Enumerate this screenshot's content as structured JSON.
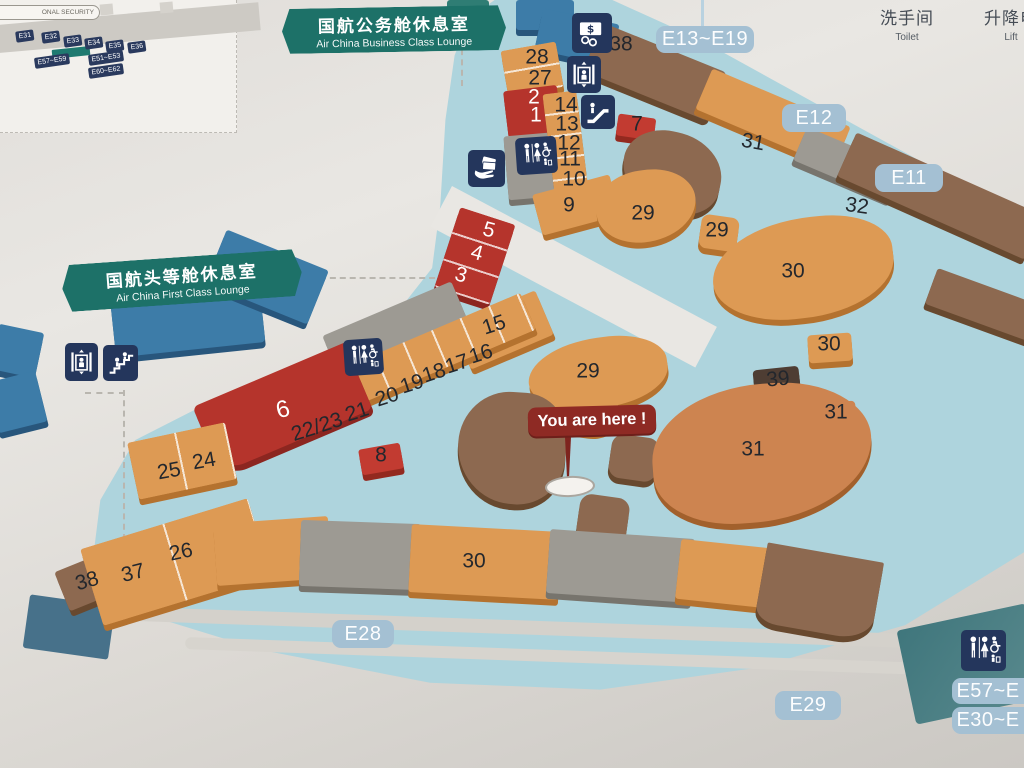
{
  "legend": {
    "toilet_zh": "洗手间",
    "toilet_en": "Toilet",
    "lift_zh": "升降电",
    "lift_en": "Lift"
  },
  "banners": {
    "business": {
      "zh": "国航公务舱休息室",
      "en": "Air China Business Class Lounge"
    },
    "first": {
      "zh": "国航头等舱休息室",
      "en": "Air China First Class Lounge"
    }
  },
  "you_are_here": {
    "label": "You are here !"
  },
  "inset": {
    "security_label": "ONAL SECURITY",
    "chips": [
      {
        "label": "E31",
        "x": 25,
        "y": 36
      },
      {
        "label": "E32",
        "x": 51,
        "y": 37
      },
      {
        "label": "E33",
        "x": 73,
        "y": 41
      },
      {
        "label": "E34",
        "x": 94,
        "y": 43
      },
      {
        "label": "E35",
        "x": 115,
        "y": 46
      },
      {
        "label": "E36",
        "x": 137,
        "y": 47
      },
      {
        "label": "E57~E59",
        "x": 52,
        "y": 61
      },
      {
        "label": "E51~E53",
        "x": 106,
        "y": 58
      },
      {
        "label": "E60~E62",
        "x": 106,
        "y": 71
      }
    ]
  },
  "gates": [
    {
      "label": "E13~E19",
      "x": 656,
      "y": 26,
      "w": 98,
      "h": 27
    },
    {
      "label": "E12",
      "x": 782,
      "y": 104,
      "w": 64,
      "h": 28
    },
    {
      "label": "E11",
      "x": 875,
      "y": 164,
      "w": 68,
      "h": 28
    },
    {
      "label": "E28",
      "x": 332,
      "y": 620,
      "w": 62,
      "h": 28
    },
    {
      "label": "E29",
      "x": 775,
      "y": 691,
      "w": 66,
      "h": 29
    },
    {
      "label": "E57~E",
      "x": 952,
      "y": 678,
      "w": 72,
      "h": 26,
      "cut": true
    },
    {
      "label": "E30~E",
      "x": 952,
      "y": 707,
      "w": 72,
      "h": 27,
      "cut": true
    }
  ],
  "markers": [
    {
      "t": "28",
      "x": 537,
      "y": 57
    },
    {
      "t": "27",
      "x": 540,
      "y": 78
    },
    {
      "t": "2",
      "x": 534,
      "y": 97,
      "white": true
    },
    {
      "t": "1",
      "x": 536,
      "y": 115,
      "white": true
    },
    {
      "t": "14",
      "x": 566,
      "y": 105
    },
    {
      "t": "13",
      "x": 567,
      "y": 124
    },
    {
      "t": "12",
      "x": 569,
      "y": 143
    },
    {
      "t": "11",
      "x": 570,
      "y": 159
    },
    {
      "t": "10",
      "x": 574,
      "y": 179
    },
    {
      "t": "9",
      "x": 569,
      "y": 205
    },
    {
      "t": "5",
      "x": 489,
      "y": 230,
      "white": true,
      "rot": 15
    },
    {
      "t": "4",
      "x": 477,
      "y": 253,
      "white": true,
      "rot": 15
    },
    {
      "t": "3",
      "x": 461,
      "y": 275,
      "white": true,
      "rot": 15
    },
    {
      "t": "38",
      "x": 621,
      "y": 44
    },
    {
      "t": "7",
      "x": 637,
      "y": 124
    },
    {
      "t": "31",
      "x": 753,
      "y": 142,
      "rot": 10
    },
    {
      "t": "29",
      "x": 643,
      "y": 213
    },
    {
      "t": "29",
      "x": 717,
      "y": 230
    },
    {
      "t": "32",
      "x": 857,
      "y": 206,
      "rot": 8
    },
    {
      "t": "30",
      "x": 793,
      "y": 271
    },
    {
      "t": "30",
      "x": 829,
      "y": 344
    },
    {
      "t": "39",
      "x": 778,
      "y": 379,
      "rot": -6
    },
    {
      "t": "31",
      "x": 836,
      "y": 412
    },
    {
      "t": "29",
      "x": 588,
      "y": 371
    },
    {
      "t": "31",
      "x": 753,
      "y": 449
    },
    {
      "t": "15",
      "x": 494,
      "y": 325,
      "rot": -18
    },
    {
      "t": "16",
      "x": 481,
      "y": 354,
      "rot": -18
    },
    {
      "t": "17",
      "x": 457,
      "y": 364,
      "rot": -18
    },
    {
      "t": "18",
      "x": 434,
      "y": 373,
      "rot": -18
    },
    {
      "t": "19",
      "x": 412,
      "y": 384,
      "rot": -18
    },
    {
      "t": "20",
      "x": 387,
      "y": 397,
      "rot": -18
    },
    {
      "t": "21",
      "x": 357,
      "y": 412,
      "rot": -18
    },
    {
      "t": "22/23",
      "x": 317,
      "y": 427,
      "rot": -18
    },
    {
      "t": "6",
      "x": 283,
      "y": 410,
      "white": true,
      "rot": -15,
      "size": 24
    },
    {
      "t": "8",
      "x": 381,
      "y": 455
    },
    {
      "t": "24",
      "x": 204,
      "y": 461,
      "rot": -10
    },
    {
      "t": "25",
      "x": 169,
      "y": 471,
      "rot": -10
    },
    {
      "t": "26",
      "x": 181,
      "y": 552,
      "rot": -12
    },
    {
      "t": "37",
      "x": 133,
      "y": 573,
      "rot": -14
    },
    {
      "t": "38",
      "x": 87,
      "y": 581,
      "rot": -16
    },
    {
      "t": "30",
      "x": 474,
      "y": 561
    }
  ],
  "icons": [
    {
      "type": "currency",
      "name": "currency-exchange-icon",
      "x": 572,
      "y": 13,
      "w": 40,
      "h": 40
    },
    {
      "type": "lift",
      "name": "elevator-icon",
      "x": 567,
      "y": 56,
      "w": 34,
      "h": 37
    },
    {
      "type": "escalator",
      "name": "escalator-icon",
      "x": 581,
      "y": 95,
      "w": 34,
      "h": 34
    },
    {
      "type": "toiletwide",
      "name": "toilet-icon",
      "x": 516,
      "y": 137,
      "w": 41,
      "h": 37,
      "rot": -4
    },
    {
      "type": "handcard",
      "name": "hand-banknotes-icon",
      "x": 468,
      "y": 150,
      "w": 37,
      "h": 37
    },
    {
      "type": "lift",
      "name": "elevator-icon",
      "x": 65,
      "y": 343,
      "w": 33,
      "h": 38
    },
    {
      "type": "stairs",
      "name": "stairs-icon",
      "x": 103,
      "y": 345,
      "w": 35,
      "h": 36
    },
    {
      "type": "toiletwide",
      "name": "toilet-icon",
      "x": 344,
      "y": 339,
      "w": 39,
      "h": 36,
      "rot": -4
    },
    {
      "type": "toiletwide",
      "name": "toilet-icon",
      "x": 961,
      "y": 630,
      "w": 45,
      "h": 41
    }
  ],
  "colors": {
    "orange": [
      "#dd9a54",
      "#b4722f"
    ],
    "orange2": [
      "#cd8450",
      "#a2602c"
    ],
    "red": [
      "#b5342c",
      "#8c2620"
    ],
    "red2": [
      "#c23b31",
      "#93291f"
    ],
    "brown": [
      "#8d6950",
      "#68492f"
    ],
    "darkbrown": [
      "#4e3d33",
      "#332820"
    ],
    "gray": [
      "#9d9a93",
      "#77746d"
    ],
    "blue": [
      "#3d7ca8",
      "#28567c"
    ],
    "teal2": [
      "#2f7d74",
      "#1f5a54"
    ]
  },
  "map_blocks": [
    {
      "id": "business-lounge-shape-a",
      "x": 516,
      "y": 0,
      "w": 58,
      "h": 30,
      "rot": 0,
      "c": "blue"
    },
    {
      "id": "business-lounge-shape-b",
      "x": 538,
      "y": 16,
      "w": 78,
      "h": 42,
      "rot": 12,
      "c": "blue"
    },
    {
      "id": "teal-tile-top",
      "x": 447,
      "y": 0,
      "w": 42,
      "h": 12,
      "rot": 0,
      "c": "teal2"
    },
    {
      "id": "shops-28-27",
      "x": 504,
      "y": 46,
      "w": 56,
      "h": 46,
      "rot": -10,
      "c": "orange",
      "seg": "180,23"
    },
    {
      "id": "shops-1-2",
      "x": 506,
      "y": 88,
      "w": 54,
      "h": 52,
      "rot": -7,
      "c": "red"
    },
    {
      "id": "toilet-block-top",
      "x": 506,
      "y": 134,
      "w": 56,
      "h": 64,
      "rot": -5,
      "c": "gray"
    },
    {
      "id": "shops-14-10",
      "x": 549,
      "y": 92,
      "w": 34,
      "h": 110,
      "rot": -7,
      "c": "orange",
      "seg": "180,22"
    },
    {
      "id": "shop-9",
      "x": 536,
      "y": 184,
      "w": 80,
      "h": 42,
      "rot": -15,
      "c": "orange"
    },
    {
      "id": "shops-3-4-5",
      "x": 446,
      "y": 214,
      "w": 58,
      "h": 84,
      "rot": 18,
      "c": "red",
      "seg": "180,28"
    },
    {
      "id": "pier-brown-38",
      "x": 588,
      "y": 46,
      "w": 135,
      "h": 52,
      "rot": 22,
      "c": "brown",
      "r": "6px"
    },
    {
      "id": "shop-7",
      "x": 617,
      "y": 116,
      "w": 38,
      "h": 22,
      "rot": 8,
      "c": "red2"
    },
    {
      "id": "blob-brown-ne",
      "x": 622,
      "y": 132,
      "w": 100,
      "h": 80,
      "rot": 12,
      "c": "brown",
      "r": "45% 55% 40% 60%"
    },
    {
      "id": "shop-29-a",
      "x": 596,
      "y": 170,
      "w": 100,
      "h": 72,
      "rot": -6,
      "c": "orange",
      "r": "50% 45% 55% 45%"
    },
    {
      "id": "shop-31-top",
      "x": 698,
      "y": 96,
      "w": 150,
      "h": 44,
      "rot": 23,
      "c": "orange"
    },
    {
      "id": "gray-ne-strip",
      "x": 796,
      "y": 146,
      "w": 105,
      "h": 36,
      "rot": 23,
      "c": "gray"
    },
    {
      "id": "brown-ne-strip",
      "x": 838,
      "y": 172,
      "w": 205,
      "h": 48,
      "rot": 24,
      "c": "brown"
    },
    {
      "id": "brown-edge-strip",
      "x": 928,
      "y": 286,
      "w": 112,
      "h": 38,
      "rot": 20,
      "c": "brown"
    },
    {
      "id": "shop-29-b",
      "x": 700,
      "y": 216,
      "w": 38,
      "h": 34,
      "rot": 8,
      "c": "orange",
      "r": "8px"
    },
    {
      "id": "shop-30-a",
      "x": 712,
      "y": 218,
      "w": 182,
      "h": 100,
      "rot": -6,
      "c": "orange",
      "r": "60% 40% 55% 45%"
    },
    {
      "id": "shop-30-b",
      "x": 808,
      "y": 334,
      "w": 44,
      "h": 28,
      "rot": -4,
      "c": "orange",
      "r": "4px"
    },
    {
      "id": "shop-39",
      "x": 754,
      "y": 368,
      "w": 46,
      "h": 32,
      "rot": -6,
      "c": "darkbrown",
      "r": "4px"
    },
    {
      "id": "shop-31-b",
      "x": 814,
      "y": 402,
      "w": 42,
      "h": 28,
      "rot": -4,
      "c": "orange2",
      "r": "4px"
    },
    {
      "id": "shop-29-c",
      "x": 528,
      "y": 338,
      "w": 140,
      "h": 70,
      "rot": -8,
      "c": "orange",
      "r": "55% 45% 50% 50%"
    },
    {
      "id": "shop-29-c2",
      "x": 552,
      "y": 388,
      "w": 66,
      "h": 44,
      "rot": 8,
      "c": "orange",
      "r": "40%"
    },
    {
      "id": "brown-center-blob",
      "x": 458,
      "y": 392,
      "w": 108,
      "h": 112,
      "rot": 4,
      "c": "brown",
      "r": "50% 42% 46% 55%"
    },
    {
      "id": "hex-tile-1",
      "x": 610,
      "y": 436,
      "w": 48,
      "h": 44,
      "rot": 8,
      "c": "brown",
      "r": "12px"
    },
    {
      "id": "hex-tile-2",
      "x": 578,
      "y": 496,
      "w": 50,
      "h": 46,
      "rot": 8,
      "c": "brown",
      "r": "12px"
    },
    {
      "id": "shop-31-big",
      "x": 652,
      "y": 384,
      "w": 220,
      "h": 138,
      "rot": -4,
      "c": "orange2",
      "r": "55% 45% 60% 40%"
    },
    {
      "id": "toilet-block-mid",
      "x": 330,
      "y": 306,
      "w": 140,
      "h": 68,
      "rot": -23,
      "c": "gray"
    },
    {
      "id": "shop-15-area",
      "x": 458,
      "y": 306,
      "w": 90,
      "h": 48,
      "rot": -23,
      "c": "orange"
    },
    {
      "id": "shops-16-23",
      "x": 288,
      "y": 340,
      "w": 250,
      "h": 40,
      "rot": -23,
      "c": "orange",
      "seg": "90,31"
    },
    {
      "id": "shop-6",
      "x": 200,
      "y": 372,
      "w": 165,
      "h": 72,
      "rot": -23,
      "c": "red",
      "r": "6px 2px 6px 26px"
    },
    {
      "id": "shops-24-25",
      "x": 132,
      "y": 432,
      "w": 100,
      "h": 58,
      "rot": -12,
      "c": "orange",
      "seg": "90,50"
    },
    {
      "id": "shop-8",
      "x": 360,
      "y": 446,
      "w": 42,
      "h": 26,
      "rot": -10,
      "c": "red2",
      "r": "3px"
    },
    {
      "id": "shop-38-b",
      "x": 60,
      "y": 560,
      "w": 58,
      "h": 42,
      "rot": -22,
      "c": "brown"
    },
    {
      "id": "shops-37-26",
      "x": 88,
      "y": 522,
      "w": 175,
      "h": 80,
      "rot": -17,
      "c": "orange",
      "seg": "90,88"
    },
    {
      "id": "bottom-orange-ext",
      "x": 215,
      "y": 520,
      "w": 115,
      "h": 62,
      "rot": -4,
      "c": "orange"
    },
    {
      "id": "bottom-gray-a",
      "x": 300,
      "y": 522,
      "w": 120,
      "h": 66,
      "rot": 2,
      "c": "gray"
    },
    {
      "id": "shop-30-c",
      "x": 410,
      "y": 528,
      "w": 150,
      "h": 68,
      "rot": 3,
      "c": "orange"
    },
    {
      "id": "bottom-gray-b",
      "x": 548,
      "y": 534,
      "w": 145,
      "h": 64,
      "rot": 4,
      "c": "gray"
    },
    {
      "id": "bottom-orange-d",
      "x": 678,
      "y": 544,
      "w": 100,
      "h": 60,
      "rot": 6,
      "c": "orange"
    },
    {
      "id": "bottom-brown-end",
      "x": 760,
      "y": 552,
      "w": 118,
      "h": 80,
      "rot": 10,
      "c": "brown",
      "r": "2px 2px 30% 20%"
    },
    {
      "id": "first-lounge-shape-a",
      "x": 112,
      "y": 278,
      "w": 150,
      "h": 72,
      "rot": -6,
      "c": "blue",
      "r": "4px"
    },
    {
      "id": "first-lounge-shape-b",
      "x": 212,
      "y": 248,
      "w": 110,
      "h": 58,
      "rot": 22,
      "c": "blue"
    },
    {
      "id": "left-wedge-a",
      "x": -6,
      "y": 328,
      "w": 46,
      "h": 46,
      "rot": 12,
      "c": "blue"
    },
    {
      "id": "left-wedge-b",
      "x": -8,
      "y": 376,
      "w": 50,
      "h": 52,
      "rot": -14,
      "c": "blue"
    }
  ]
}
